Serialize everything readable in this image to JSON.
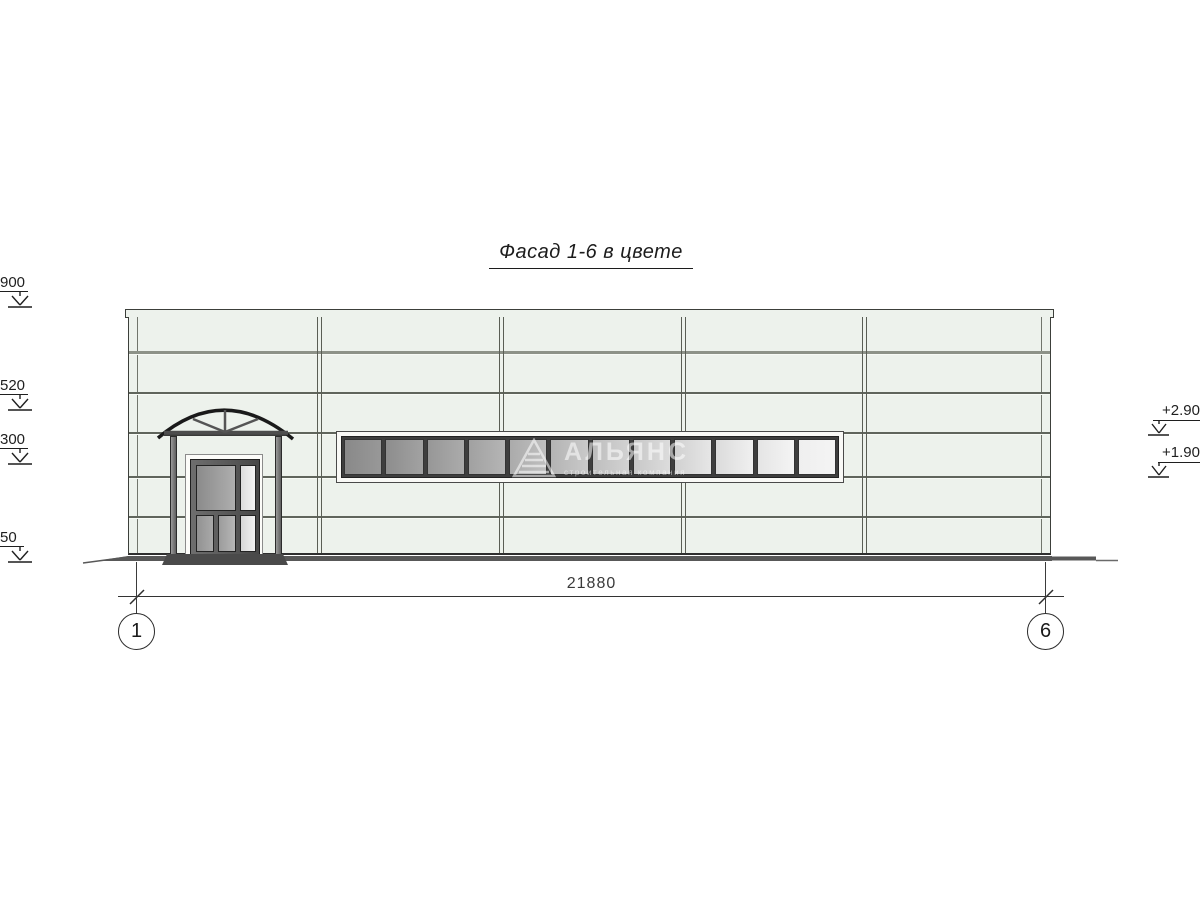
{
  "drawing": {
    "title": "Фасад 1-6 в цвете",
    "dimension_label": "21880",
    "axis_left": "1",
    "axis_right": "6",
    "elevation_marks_left": [
      {
        "label": "900"
      },
      {
        "label": "520"
      },
      {
        "label": "300"
      },
      {
        "label": "50"
      }
    ],
    "elevation_marks_right": [
      {
        "label": "+2.90"
      },
      {
        "label": "+1.90"
      }
    ],
    "watermark": {
      "name": "АЛЬЯНС",
      "subtitle": "строительная компания"
    },
    "window_strip": {
      "pane_count": 12
    }
  },
  "colors": {
    "facade": "#edf2ec",
    "outline": "#3c3f3a",
    "joint": "#60655c",
    "joint-light": "#f7faf5",
    "glass-dark": "#898989",
    "glass-light": "#f4f4f4",
    "ground": "#585858",
    "watermark": "rgba(255,255,255,0.55)"
  }
}
